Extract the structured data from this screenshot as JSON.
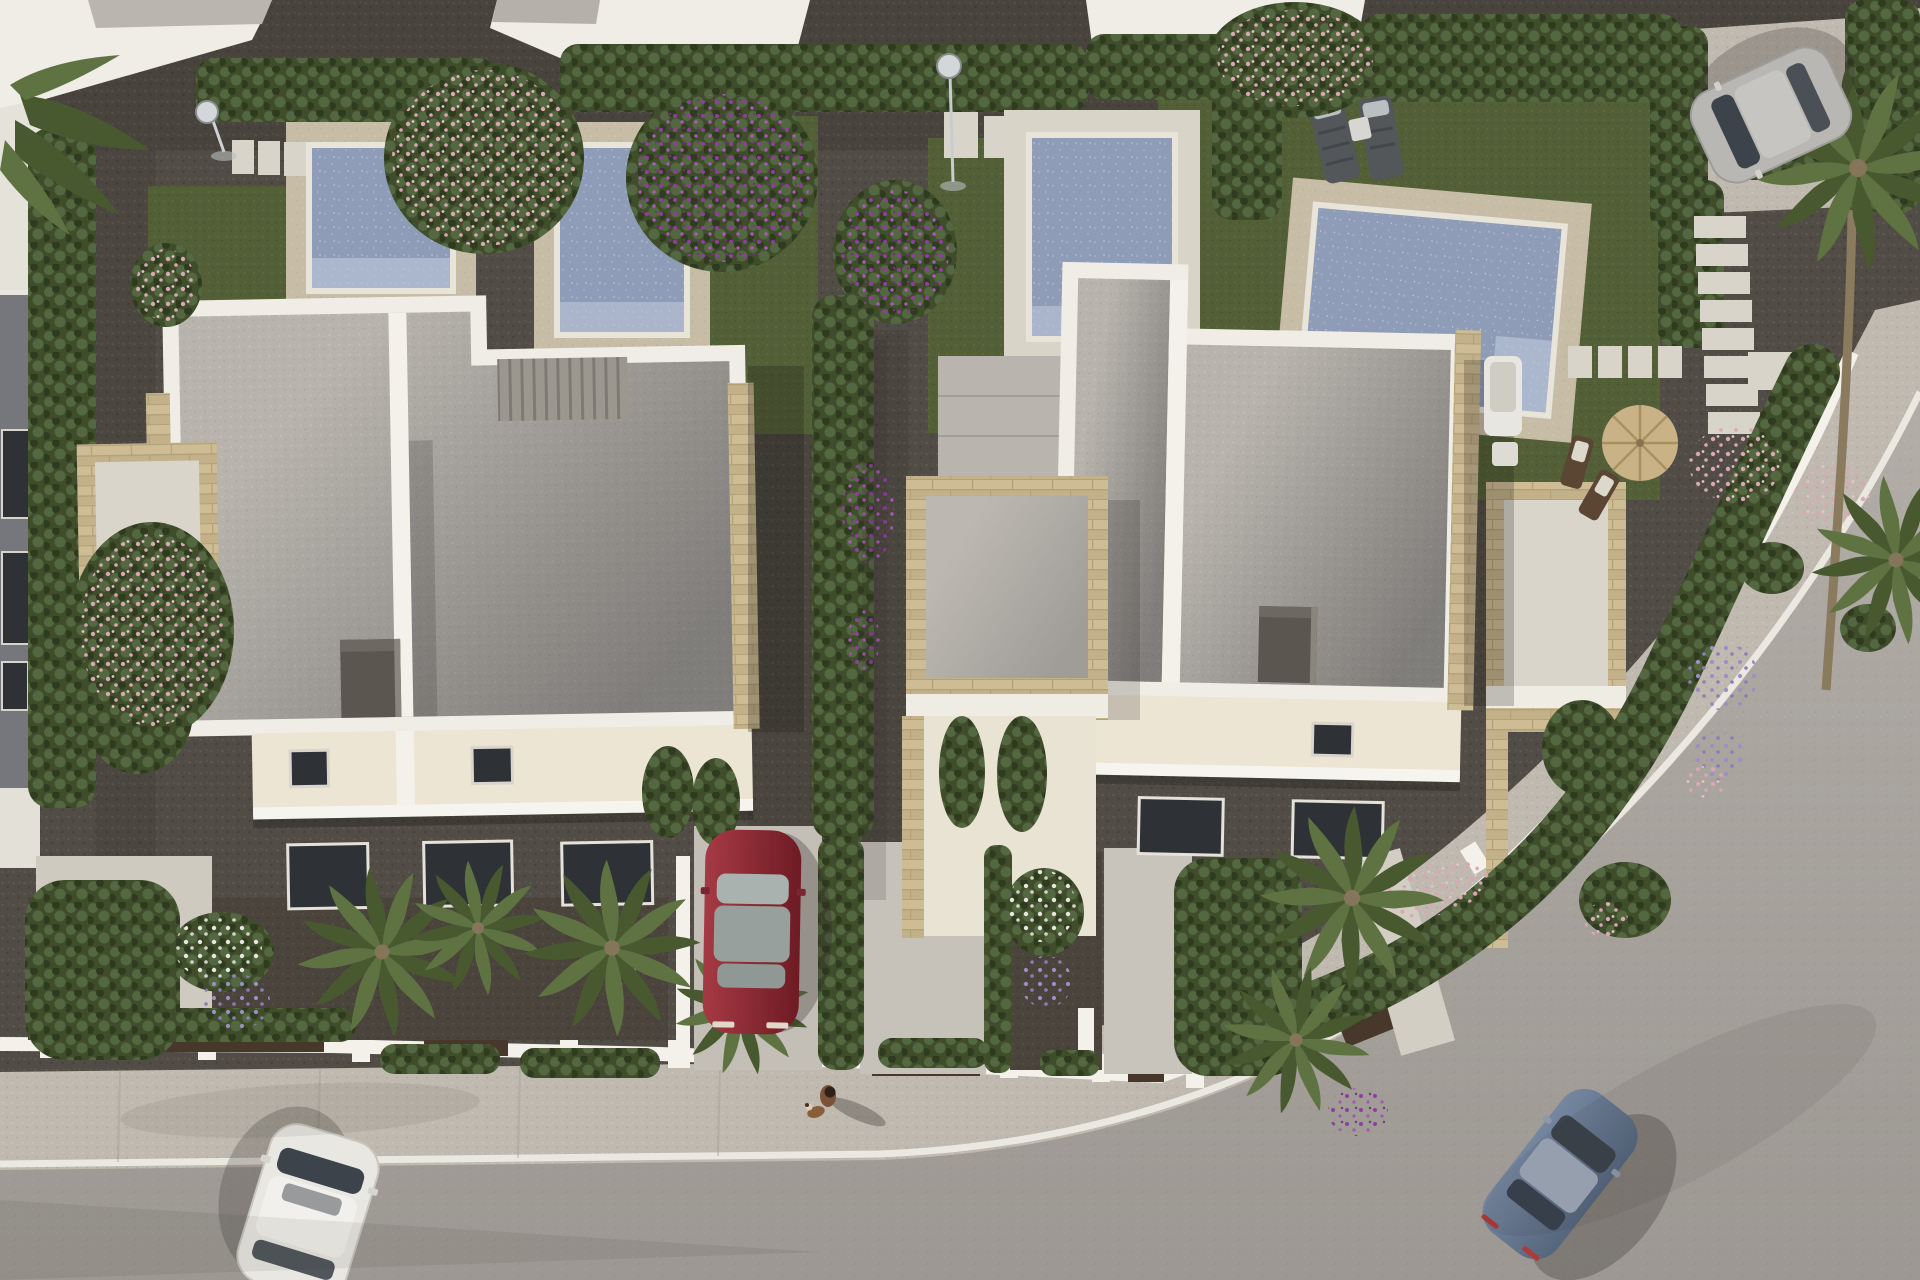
{
  "meta": {
    "title": "Aerial 3D render of a modern villa development",
    "description": "Top-down architectural visualization: two white semi-detached villas with flat gravel roofs and travertine-clad terraces, four rectangular swimming pools with decks, lawns, gravel gardens with purple bougainvillea, hedges and palm trees, a curved asphalt road with sidewalk at the bottom right, a parked red car, a white car and a blue car driving on the road, a silver car on a driveway at the top right, two sun loungers, a straw parasol with deck chairs, and a tiny person walking a dog on the pavement."
  },
  "scene": {
    "villas": [
      {
        "label": "left-villa",
        "roof": "grey gravel, white parapet",
        "accent": "travertine stone"
      },
      {
        "label": "right-villa",
        "roof": "grey gravel, white parapet",
        "accent": "travertine stone"
      }
    ],
    "pools": 4,
    "cars": [
      {
        "label": "white-car",
        "state": "driving on road, bottom left"
      },
      {
        "label": "red-car",
        "state": "parked in driveway, center"
      },
      {
        "label": "blue-car",
        "state": "driving on curved road, bottom right"
      },
      {
        "label": "silver-car",
        "state": "parked on driveway, top right"
      }
    ],
    "people": [
      {
        "label": "pedestrian-with-dog",
        "location": "sidewalk, center bottom"
      }
    ],
    "vegetation": [
      "cypress hedges",
      "palm trees",
      "purple bougainvillea",
      "pink flowering trees",
      "hydrangeas",
      "lavender balls",
      "lawns"
    ],
    "furniture": [
      "2 sun loungers",
      "straw parasol",
      "2 deck chairs",
      "white pool sofa",
      "2 outdoor showers",
      "stepping stones"
    ]
  },
  "palette": {
    "gravel1": "#514c45",
    "gravel2": "#5d5850",
    "gravel3": "#46423b",
    "soil": "#4a443c",
    "road1": "#b2ada7",
    "road2": "#a9a49d",
    "walk1": "#bfb9b0",
    "walk2": "#cac4ba",
    "curb": "#ebe8e1",
    "wall": "#f3f1ea",
    "villa": "#f0ede6",
    "cream": "#ece5d3",
    "roof1": "#b8b4ad",
    "roof2": "#c4c0b9",
    "roof3": "#aaa69f",
    "stone1": "#cdbc94",
    "stone2": "#b3a179",
    "deck1": "#c7bca6",
    "deck2": "#d9d4c8",
    "coping": "#e8e4d9",
    "water1": "#8e9cb7",
    "water2": "#a1aec6",
    "water3": "#bcc6d8",
    "grass1": "#535f37",
    "grass2": "#5e6b3f",
    "grass3": "#475231",
    "hedge1": "#3f4d2b",
    "hedge2": "#536740",
    "hedge3": "#2f3b1f",
    "palm1": "#5f7342",
    "palm2": "#48592f",
    "trunk": "#85755a",
    "pink": "#d9a8b2",
    "purple": "#8e3f9e",
    "violet": "#9b8fc4",
    "flwhite": "#e8e6df",
    "carwhite": "#e9e7e2",
    "carred1": "#a53a44",
    "carred2": "#6e1b24",
    "carblue1": "#7587a0",
    "carblue2": "#55667d",
    "carsilver": "#b8b7b3",
    "glass": "#3c434b",
    "chimney": "#5b564f",
    "windark": "#2e3236",
    "skin": "#7a5236",
    "dog": "#8a5f38"
  }
}
